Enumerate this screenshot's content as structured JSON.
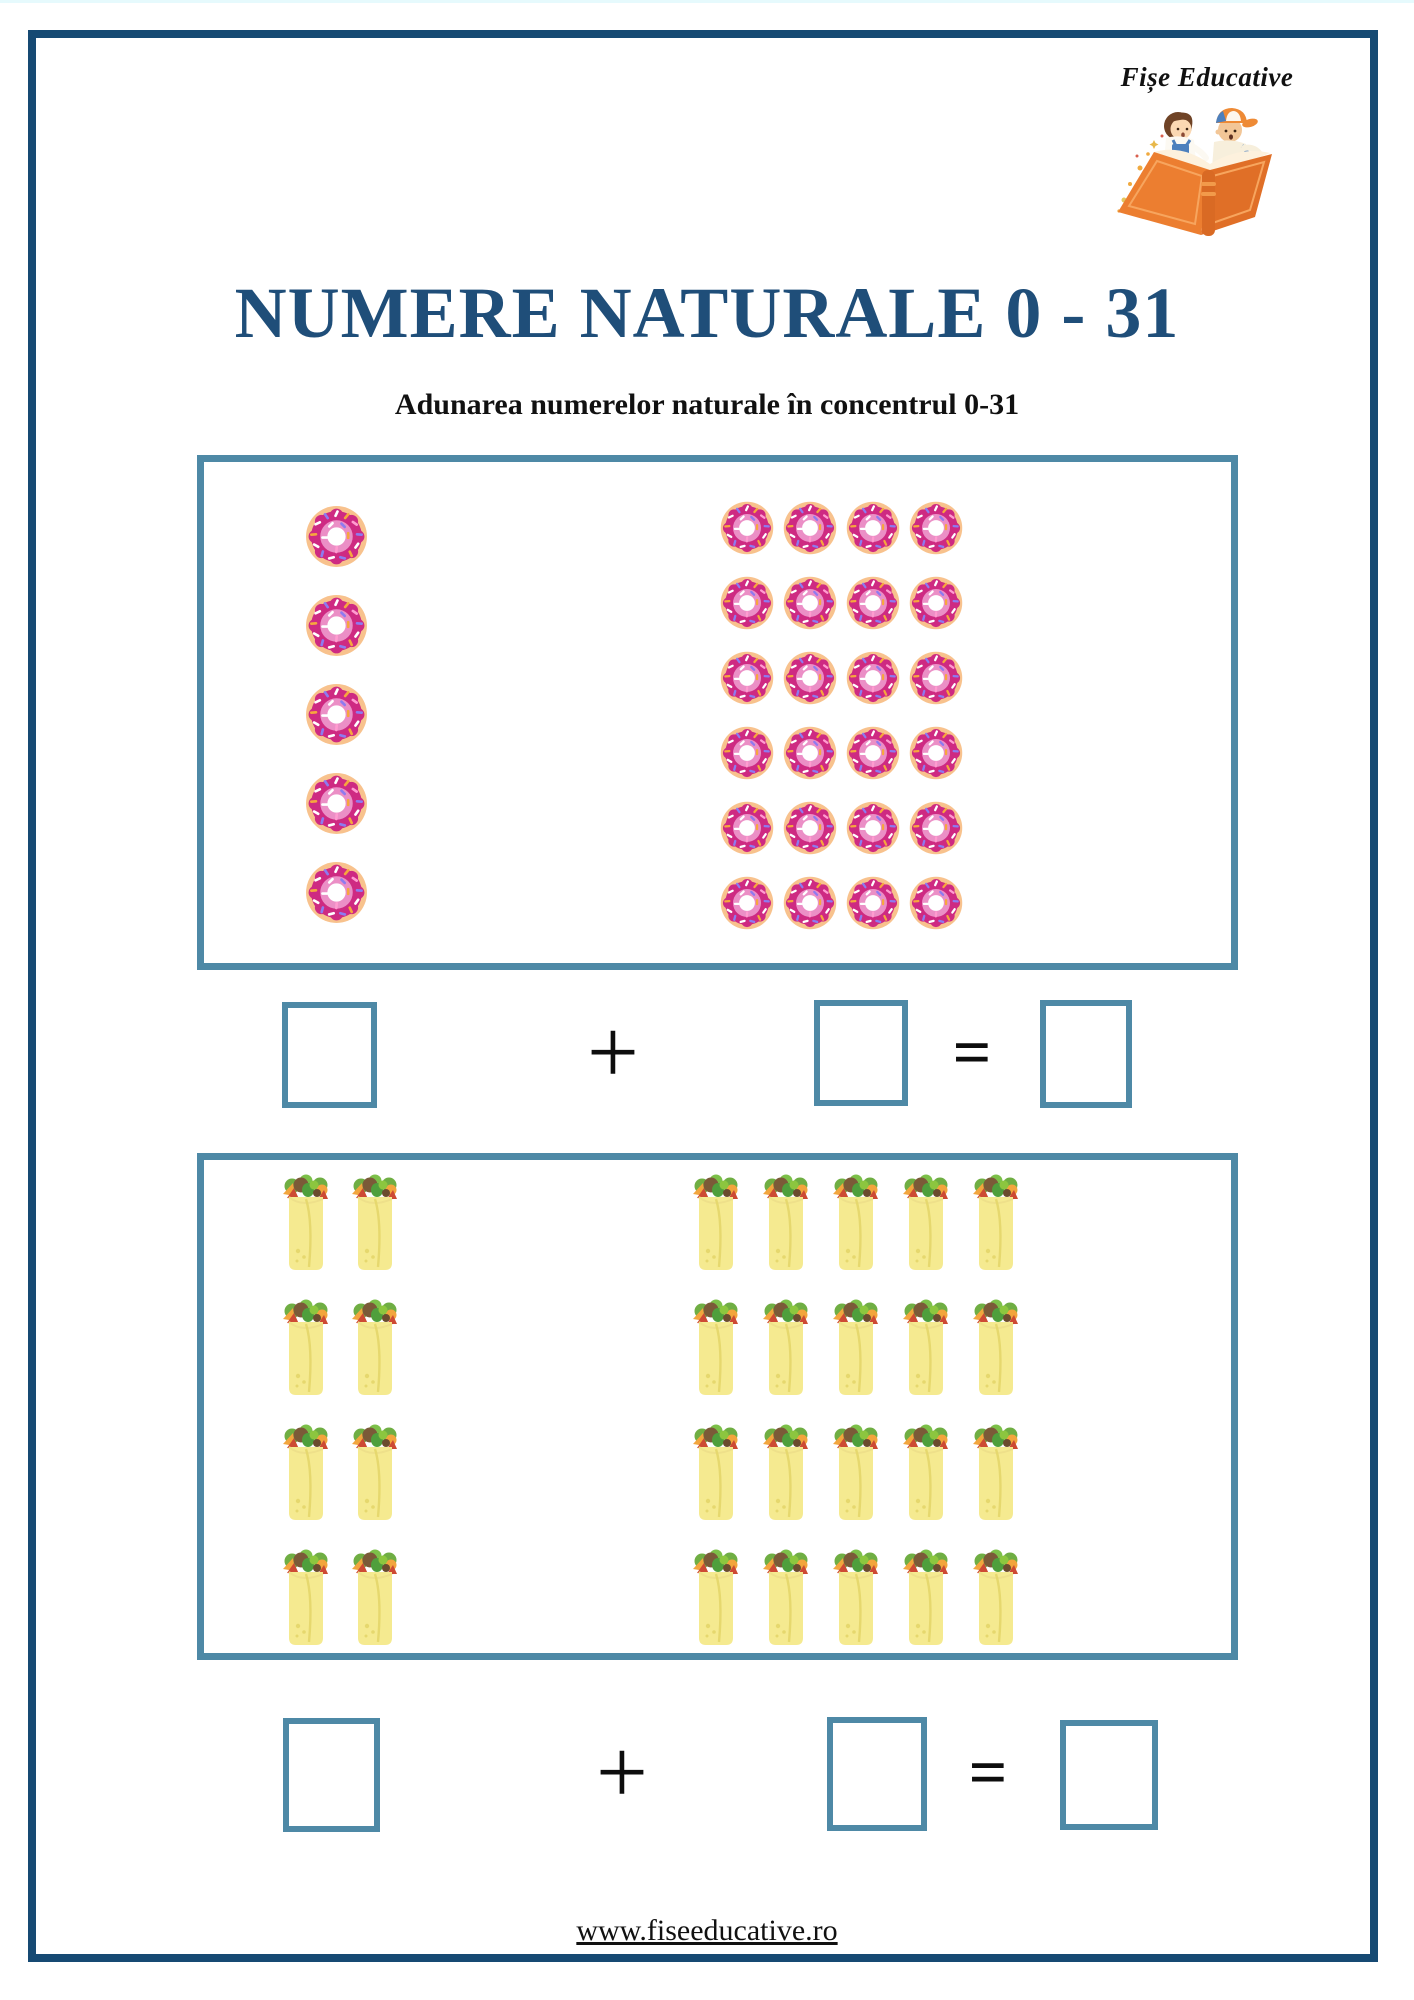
{
  "brand": {
    "name": "Fișe Educative"
  },
  "title": "NUMERE NATURALE 0 - 31",
  "subtitle": "Adunarea numerelor naturale în concentrul 0-31",
  "footer": {
    "url": "www.fiseeducative.ro"
  },
  "colors": {
    "frame_navy": "#164a73",
    "title_blue": "#1f4e79",
    "box_border_teal": "#4e89a6",
    "donut_frosting": "#ce2a82",
    "donut_base": "#f8c28d",
    "burrito_body": "#f5ea90",
    "logo_book_orange": "#ec7e30"
  },
  "exercises": [
    {
      "name": "donut-addition",
      "left_group": {
        "icon": "donut",
        "count": 5,
        "columns": 1
      },
      "right_group": {
        "icon": "donut",
        "count": 24,
        "columns": 4
      },
      "plus_sign": "+",
      "equals_sign": "=",
      "answers": {
        "first": "",
        "second": "",
        "result": ""
      }
    },
    {
      "name": "burrito-addition",
      "left_group": {
        "icon": "burrito",
        "count": 8,
        "columns": 2
      },
      "right_group": {
        "icon": "burrito",
        "count": 20,
        "columns": 5
      },
      "plus_sign": "+",
      "equals_sign": "=",
      "answers": {
        "first": "",
        "second": "",
        "result": ""
      }
    }
  ]
}
